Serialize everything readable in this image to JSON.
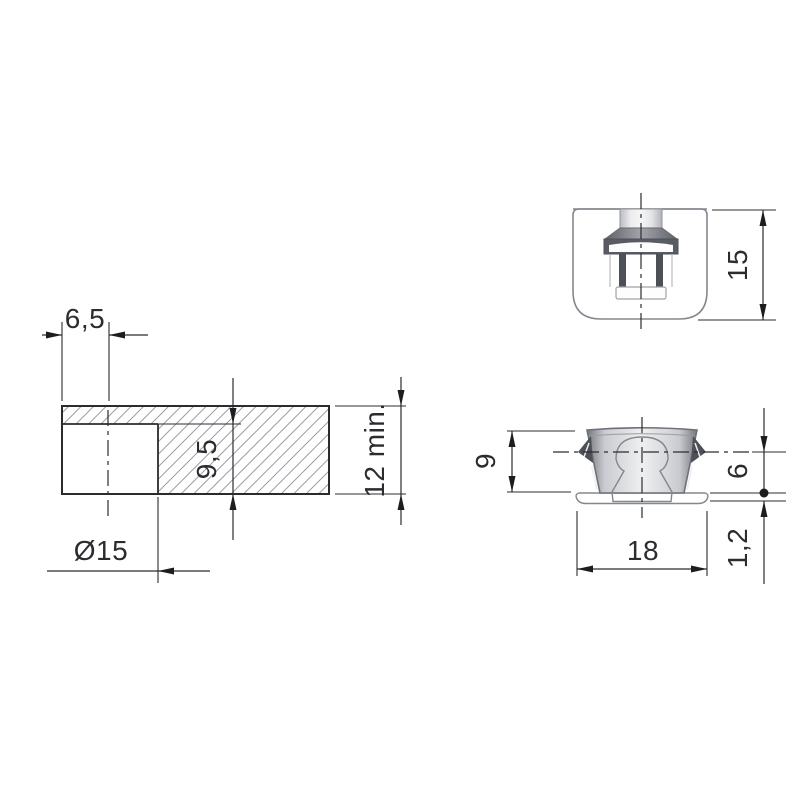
{
  "drawing": {
    "type": "technical-drawing",
    "background": "#ffffff",
    "colors": {
      "dimension_lines": "#2c2c30",
      "panel_outline": "#2b2b2e",
      "part_outline_gray": "#85878f",
      "hatch": "#9ba0a6",
      "body_fill_light": "#f3f4f6",
      "slot_dark": "#4e5057",
      "drum_dark_edge": "#75777e",
      "drum_light_center": "#eef0f1"
    },
    "views": {
      "panel_section": {
        "name": "panel cross-section with blind hole, hatched"
      },
      "housing_front": {
        "name": "cam housing front view (cup shape with neck and T-slot)"
      },
      "housing_side": {
        "name": "cam housing side view (barbed drum with flange and keyhole)"
      }
    },
    "dimensions": {
      "edge_distance": {
        "label": "6,5",
        "orientation": "horizontal"
      },
      "hole_depth": {
        "label": "9,5",
        "orientation": "vertical"
      },
      "panel_thickness": {
        "label": "12 min.",
        "orientation": "vertical"
      },
      "hole_diameter": {
        "label": "Ø15",
        "orientation": "horizontal"
      },
      "housing_height": {
        "label": "15",
        "orientation": "vertical"
      },
      "body_height": {
        "label": "9",
        "orientation": "vertical"
      },
      "anchor_depth": {
        "label": "6",
        "orientation": "vertical"
      },
      "flange_thickness": {
        "label": "1,2",
        "orientation": "vertical"
      },
      "flange_diameter": {
        "label": "18",
        "orientation": "horizontal"
      }
    }
  }
}
